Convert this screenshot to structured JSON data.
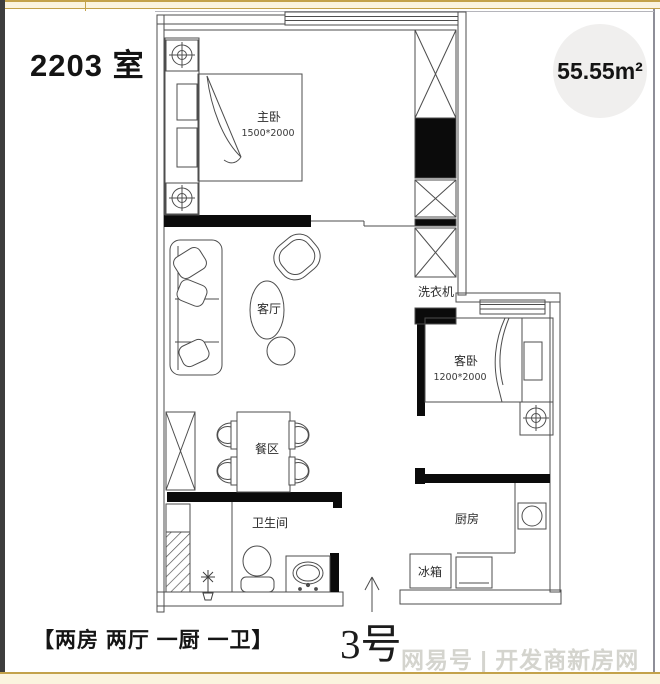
{
  "header": {
    "unit_title": "2203 室",
    "area_badge": "55.55m²"
  },
  "plan": {
    "master_bedroom": {
      "name": "主卧",
      "dimensions": "1500*2000"
    },
    "living_room": {
      "name": "客厅"
    },
    "guest_bedroom": {
      "name": "客卧",
      "dimensions": "1200*2000"
    },
    "dining_area": {
      "name": "餐区"
    },
    "bathroom": {
      "name": "卫生间"
    },
    "kitchen": {
      "name": "厨房"
    },
    "washing_machine": {
      "name": "洗衣机"
    },
    "fridge": {
      "name": "冰箱"
    }
  },
  "footer": {
    "configuration": "【两房 两厅 一厨 一卫】",
    "building_number": "3号",
    "watermark": "网易号 | 开发商新房网"
  }
}
